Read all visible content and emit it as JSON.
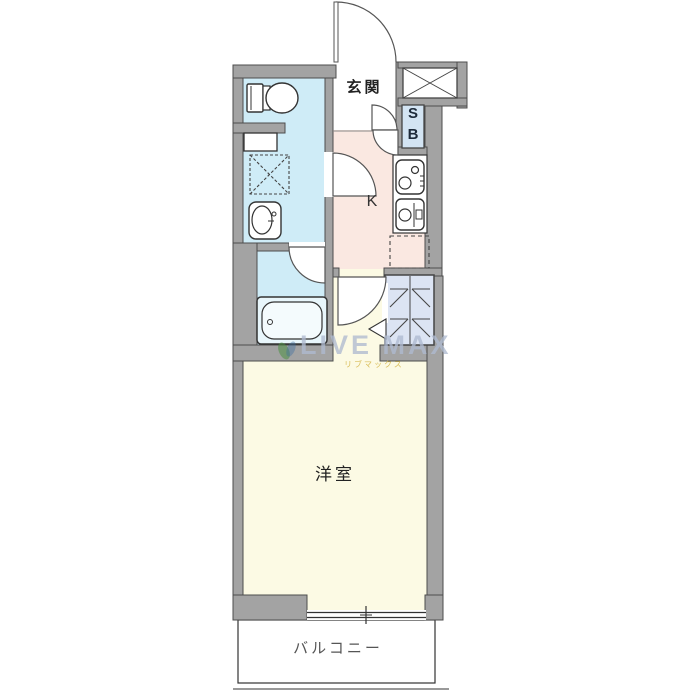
{
  "floorplan": {
    "rooms": {
      "genkan": "玄関",
      "shoebox_s": "S",
      "shoebox_b": "B",
      "kitchen": "K",
      "western_room": "洋室",
      "balcony": "バルコニー"
    },
    "watermark": {
      "brand": "LIVE MAX",
      "subtext": "リブマックス"
    },
    "colors": {
      "wall": "#a3a3a3",
      "wall_edge": "#4d4d4d",
      "washroom": "#cfecf7",
      "bathroom": "#cfecf7",
      "kitchen": "#fae8e1",
      "room": "#fcfae4",
      "closet": "#dce4f3",
      "shoebox": "#d3e4f3",
      "watermark_text": "#aebad0",
      "watermark_sub": "#d6b84c",
      "leaf_green": "#4c8f44"
    }
  }
}
